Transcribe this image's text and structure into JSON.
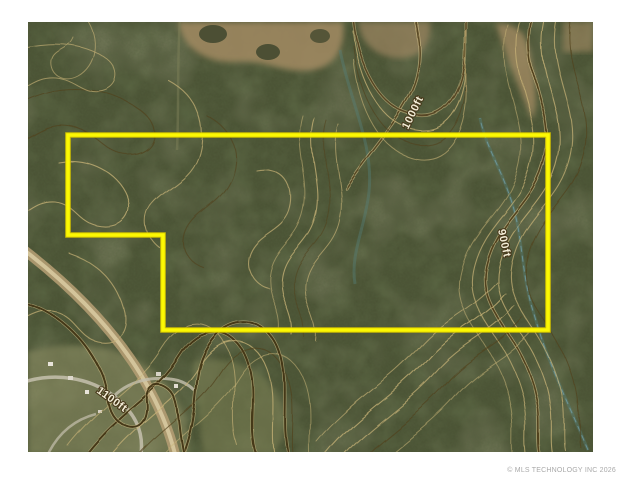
{
  "window": {
    "width": 621,
    "height": 480,
    "background": "#ffffff"
  },
  "map": {
    "kind": "aerial-imagery-with-topographic-contours",
    "base_color": "#4b5335",
    "contour_color": "#c9b478",
    "contour_index_color": "#4a3a18",
    "stream_color": "#55837c",
    "boundary": {
      "color": "#f8f400",
      "shape": "L-shaped parcel outline",
      "vertices_px": [
        [
          68,
          135
        ],
        [
          548,
          135
        ],
        [
          548,
          330
        ],
        [
          163,
          330
        ],
        [
          163,
          235
        ],
        [
          68,
          235
        ]
      ]
    },
    "contour_labels": [
      {
        "text": "1000ft"
      },
      {
        "text": "900ft"
      },
      {
        "text": "1100ft"
      }
    ]
  },
  "watermark": {
    "text": "© MLS TECHNOLOGY INC 2026"
  }
}
